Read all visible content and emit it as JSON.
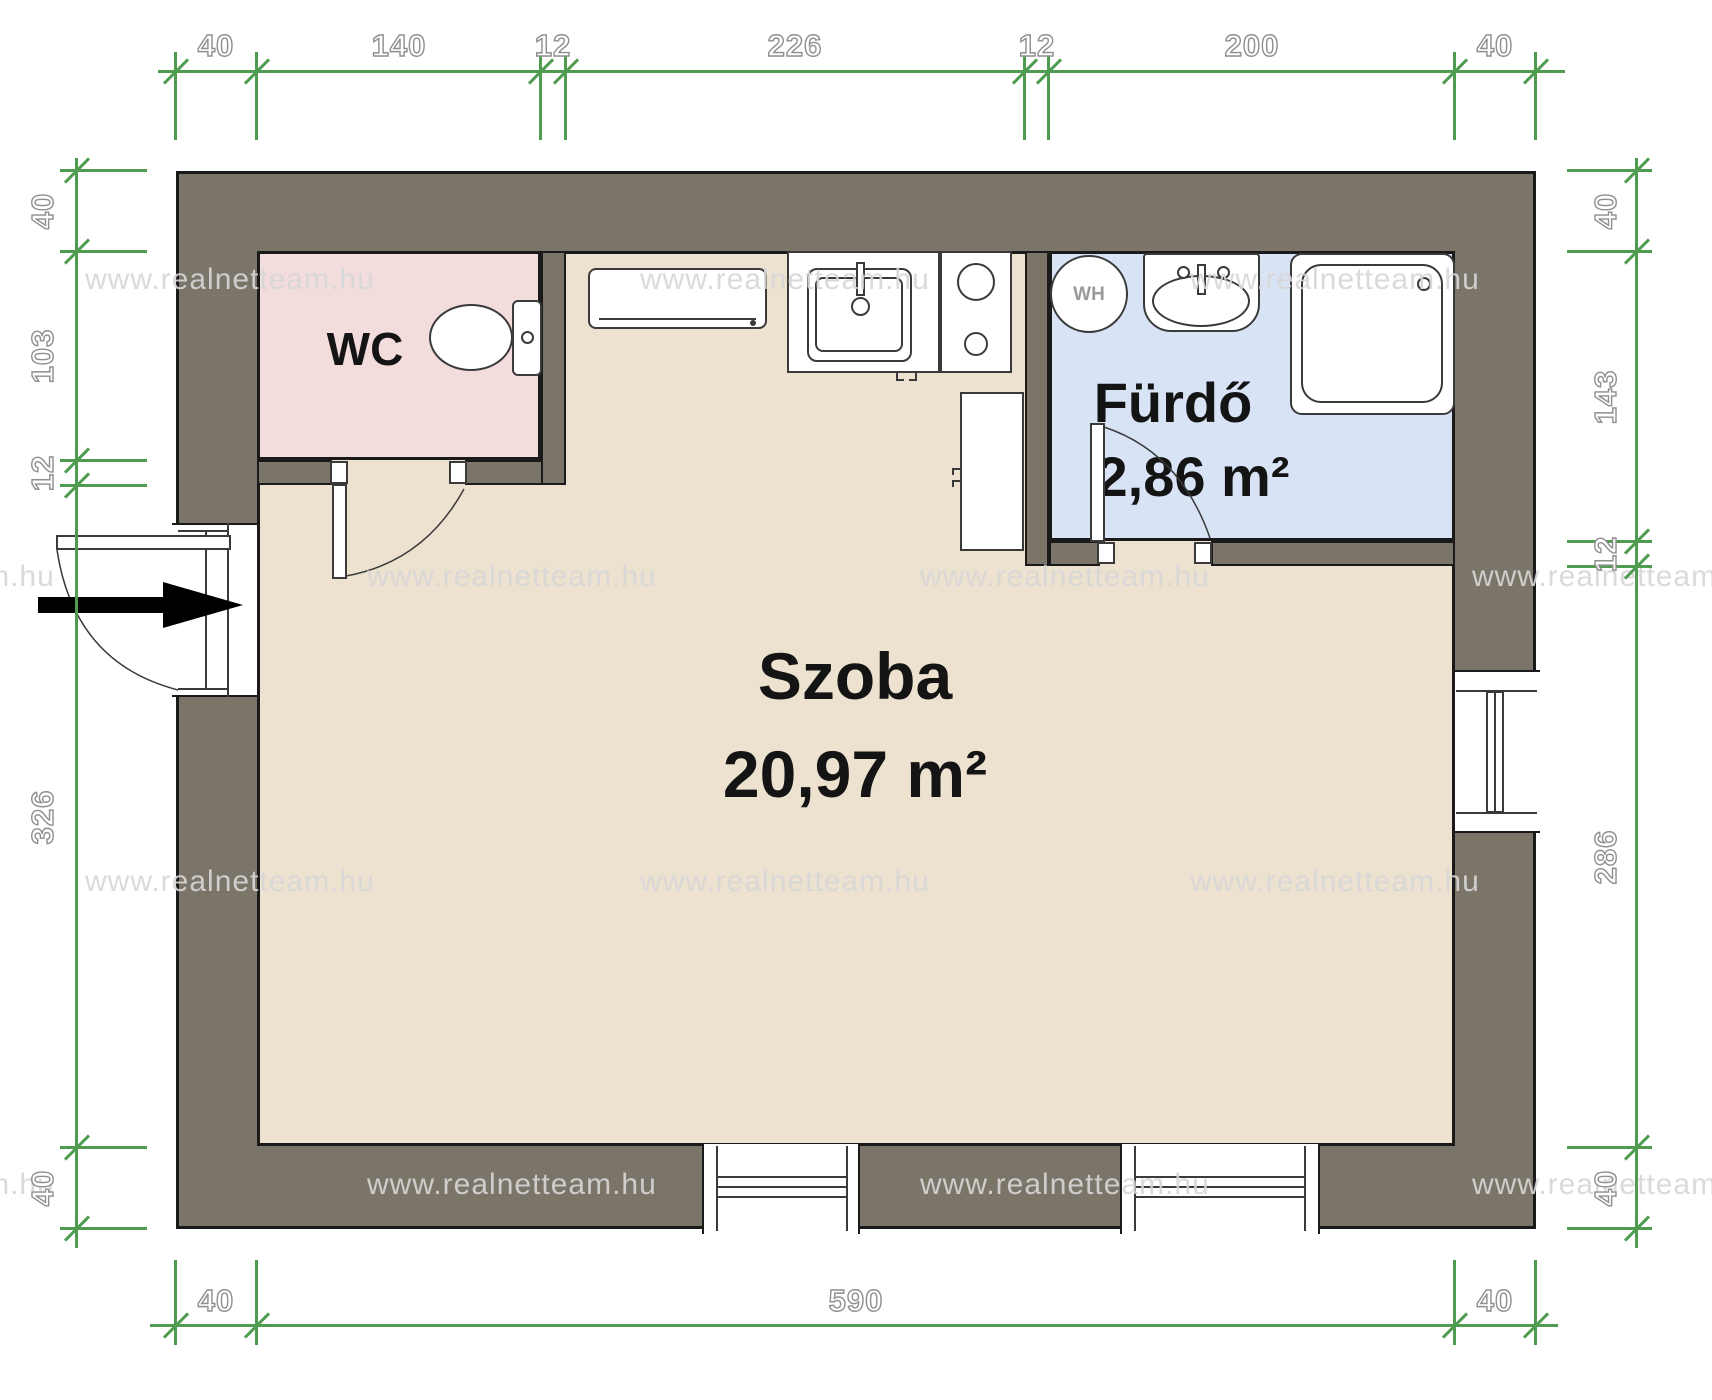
{
  "watermark": {
    "text": "www.realnetteam.hu"
  },
  "rooms": {
    "szoba": {
      "name": "Szoba",
      "area": "20,97 m²"
    },
    "furdo": {
      "name": "Fürdő",
      "area": "2,86 m²"
    },
    "wc": {
      "name": "WC"
    }
  },
  "fixtures": {
    "water_heater": "WH"
  },
  "dimensions": {
    "top": [
      "40",
      "140",
      "12",
      "226",
      "12",
      "200",
      "40"
    ],
    "bottom": [
      "40",
      "590",
      "40"
    ],
    "left": [
      "40",
      "103",
      "12",
      "326",
      "40"
    ],
    "right": [
      "40",
      "143",
      "12",
      "286",
      "40"
    ]
  },
  "colors": {
    "wall": "#7b7569",
    "outline": "#1a1a1a",
    "szoba_floor": "#ece2cf",
    "wc_floor": "#f2dddc",
    "bathroom_floor": "#d9e3f6",
    "dimension_green": "#4f9c51",
    "dimension_text": "#ffffff"
  }
}
